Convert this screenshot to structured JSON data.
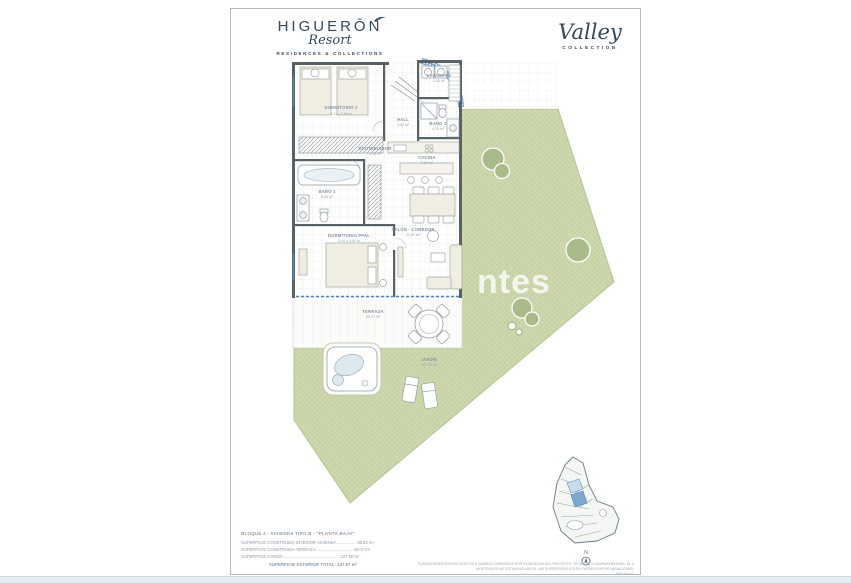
{
  "brand": {
    "name": "HIGUERŌN",
    "script": "Resort",
    "tagline": "RESIDENCES & COLLECTIONS"
  },
  "collection": {
    "name": "Valley",
    "sub": "COLLECTION"
  },
  "watermark": "ntes",
  "north_label": "N",
  "rooms": {
    "dormitorio2": {
      "label": "DORMITORIO 2",
      "dims": "3.11 x 3.68 m"
    },
    "lavadero": {
      "label": "LAVADERO",
      "dims": "2.20 m²"
    },
    "bano2": {
      "label": "BAÑO 2",
      "dims": "4.15 m²"
    },
    "hall": {
      "label": "HALL",
      "dims": "4.32 m²"
    },
    "distribuidor": {
      "label": "DISTRIBUIDOR",
      "dims": "2.56 m²"
    },
    "bano1": {
      "label": "BAÑO 1",
      "dims": "5.08 m²"
    },
    "cocina": {
      "label": "COCINA",
      "dims": "9.68 m²"
    },
    "salon": {
      "label": "SALÓN - COMEDOR",
      "dims": "21.87 m²"
    },
    "dormppal": {
      "label": "DORMITORIO PPAL",
      "dims": "3.40 x 4.01 m"
    },
    "terraza": {
      "label": "TERRAZA",
      "dims": "40.07 m²"
    },
    "jardin": {
      "label": "JARDÍN",
      "dims": "107.50 m²"
    }
  },
  "legend": {
    "title": "BLOQUE 4 - VIVIENDA TIPO B - \"PLANTA BAJA\"",
    "lines": [
      "SUPERFICIE CONSTRUIDA INTERIOR VIVIENDA ................ 88.82 m²",
      "SUPERFICIE CONSTRUIDA TERRAZA ............................... 40.07 m²",
      "SUPERFICIE JARDÍN ................................................ 107.50 m²"
    ],
    "total": "SUPERFICIE EXTERIOR TOTAL: 147.57 m²"
  },
  "disclaimer": {
    "line1": "PLANOS ORIENTATIVOS SUJETOS A CAMBIOS DERIVADOS POR EXIGENCIAS DEL PROYECTO, TÉCNICAS O ADMINISTRATIVAS. EL JARDÍN Y MOBILIARIO",
    "line2": "MOSTRADOS NO ESTÁN INCLUIDOS. LAS SUPERFICIES ÚTILES PUEDEN SUFRIR VARIACIONES.",
    "rev": "REV.02 A.C"
  },
  "colors": {
    "garden": "#ccd7ad",
    "wall": "#586165",
    "glass": "#4e86b5",
    "brand": "#35485a"
  }
}
